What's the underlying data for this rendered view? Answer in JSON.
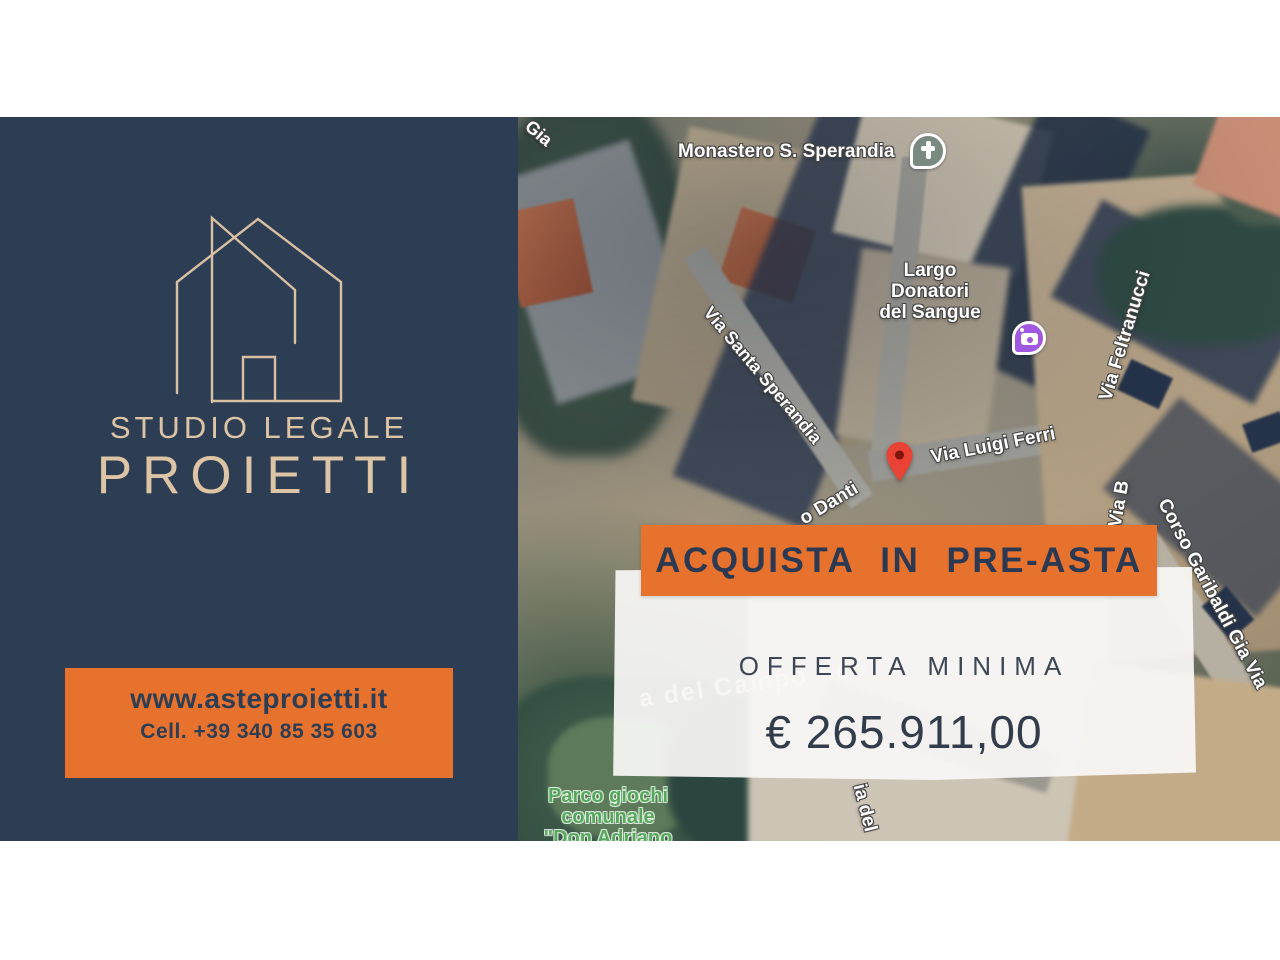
{
  "brand": {
    "line1": "STUDIO LEGALE",
    "line2": "PROIETTI"
  },
  "contact": {
    "website": "www.asteproietti.it",
    "phone": "Cell. +39 340 85 35 603"
  },
  "offer": {
    "banner": "ACQUISTA IN PRE-ASTA",
    "label": "OFFERTA MINIMA",
    "amount": "€ 265.911,00"
  },
  "map": {
    "poi_monastero": "Monastero S. Sperandia",
    "largo_line1": "Largo",
    "largo_line2": "Donatori",
    "largo_line3": "del Sangue",
    "street_gia": "Gia",
    "street_sperandia": "Via Santa Sperandia",
    "street_luigi_ferri": "Via Luigi Ferri",
    "street_danti": "o Danti",
    "street_feltranucci": "Via Feltranucci",
    "street_via_b": "Via B",
    "street_corso": "Corso Garibaldi Gia Via",
    "street_via_del": "ia del",
    "street_campo_faint": "a del Campo Sco",
    "park_line1": "Parco giochi",
    "park_line2": "comunale",
    "park_line3": "\"Don Adriano"
  },
  "colors": {
    "panel_navy": "#2d3e54",
    "accent_orange": "#e7722e",
    "logo_beige": "#dcc4a4",
    "offer_text": "#323c4b",
    "map_label_white": "#ffffff",
    "park_label_green": "#58a75e",
    "pin_red": "#ea4335",
    "church_icon": "#7b8a80",
    "photo_icon_purple": "#a158e0"
  }
}
